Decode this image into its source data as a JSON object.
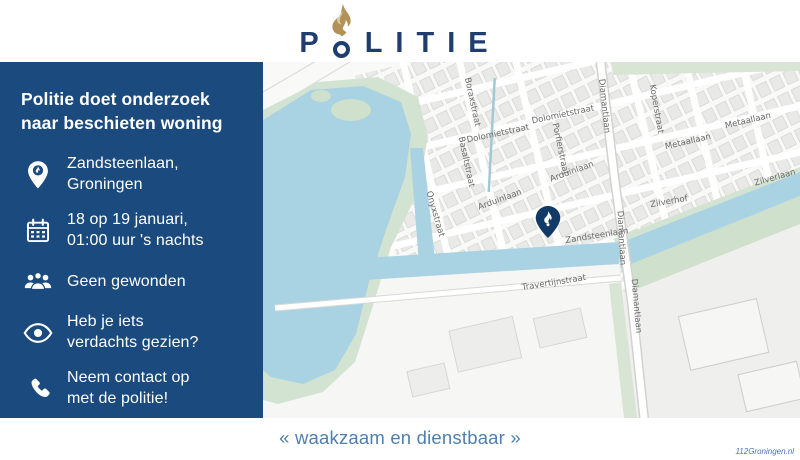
{
  "header": {
    "logo_text": "POLITIE"
  },
  "panel": {
    "title": "Politie doet onderzoek naar beschieten woning",
    "items": [
      {
        "icon": "location-pin-icon",
        "lines": [
          "Zandsteenlaan,",
          "Groningen"
        ]
      },
      {
        "icon": "calendar-icon",
        "lines": [
          "18 op 19 januari,",
          "01:00 uur 's nachts"
        ]
      },
      {
        "icon": "people-icon",
        "lines": [
          "Geen gewonden"
        ]
      },
      {
        "icon": "eye-icon",
        "lines": [
          "Heb je iets",
          "verdachts gezien?"
        ]
      },
      {
        "icon": "phone-icon",
        "lines": [
          "Neem contact op",
          "met de politie!"
        ]
      }
    ]
  },
  "map": {
    "marker": {
      "icon": "politie-pin-icon",
      "street": "Zandsteenlaan"
    },
    "street_labels": [
      {
        "name": "Boraxstraat",
        "x": 209,
        "y": 40,
        "rot": 78
      },
      {
        "name": "Dolomietstraat",
        "x": 235,
        "y": 72,
        "rot": -12
      },
      {
        "name": "Dolomietstraat",
        "x": 300,
        "y": 53,
        "rot": -12
      },
      {
        "name": "Basaltstraat",
        "x": 203,
        "y": 100,
        "rot": 78
      },
      {
        "name": "Porfierstraat",
        "x": 297,
        "y": 87,
        "rot": 78
      },
      {
        "name": "Onyxstraat",
        "x": 172,
        "y": 152,
        "rot": 74
      },
      {
        "name": "Arduinlaan",
        "x": 309,
        "y": 110,
        "rot": -20
      },
      {
        "name": "Arduinlaan",
        "x": 237,
        "y": 138,
        "rot": -20
      },
      {
        "name": "Koperstraat",
        "x": 393,
        "y": 47,
        "rot": 80
      },
      {
        "name": "Metaallaan",
        "x": 425,
        "y": 80,
        "rot": -13
      },
      {
        "name": "Metaallaan",
        "x": 485,
        "y": 59,
        "rot": -13
      },
      {
        "name": "Zilverlaan",
        "x": 512,
        "y": 116,
        "rot": -16
      },
      {
        "name": "Zilverhof",
        "x": 406,
        "y": 140,
        "rot": -10
      },
      {
        "name": "Diamantlaan",
        "x": 341,
        "y": 44,
        "rot": 84
      },
      {
        "name": "Diamantlaan",
        "x": 358,
        "y": 176,
        "rot": 87
      },
      {
        "name": "Diamantlaan",
        "x": 373,
        "y": 244,
        "rot": 85
      },
      {
        "name": "Zandsteenlaan",
        "x": 334,
        "y": 174,
        "rot": -9
      },
      {
        "name": "Travertijnstraat",
        "x": 291,
        "y": 221,
        "rot": -9
      }
    ]
  },
  "footer": {
    "slogan": "« waakzaam en dienstbaar »",
    "credit": "112Groningen.nl"
  },
  "colors": {
    "panel_bg": "#1a4a7e",
    "logo_blue": "#1f3d6e",
    "logo_gold": "#b29257",
    "map_water": "#a9d2e2",
    "map_green": "#d3e3d1",
    "slogan_blue": "#4e7fae"
  }
}
